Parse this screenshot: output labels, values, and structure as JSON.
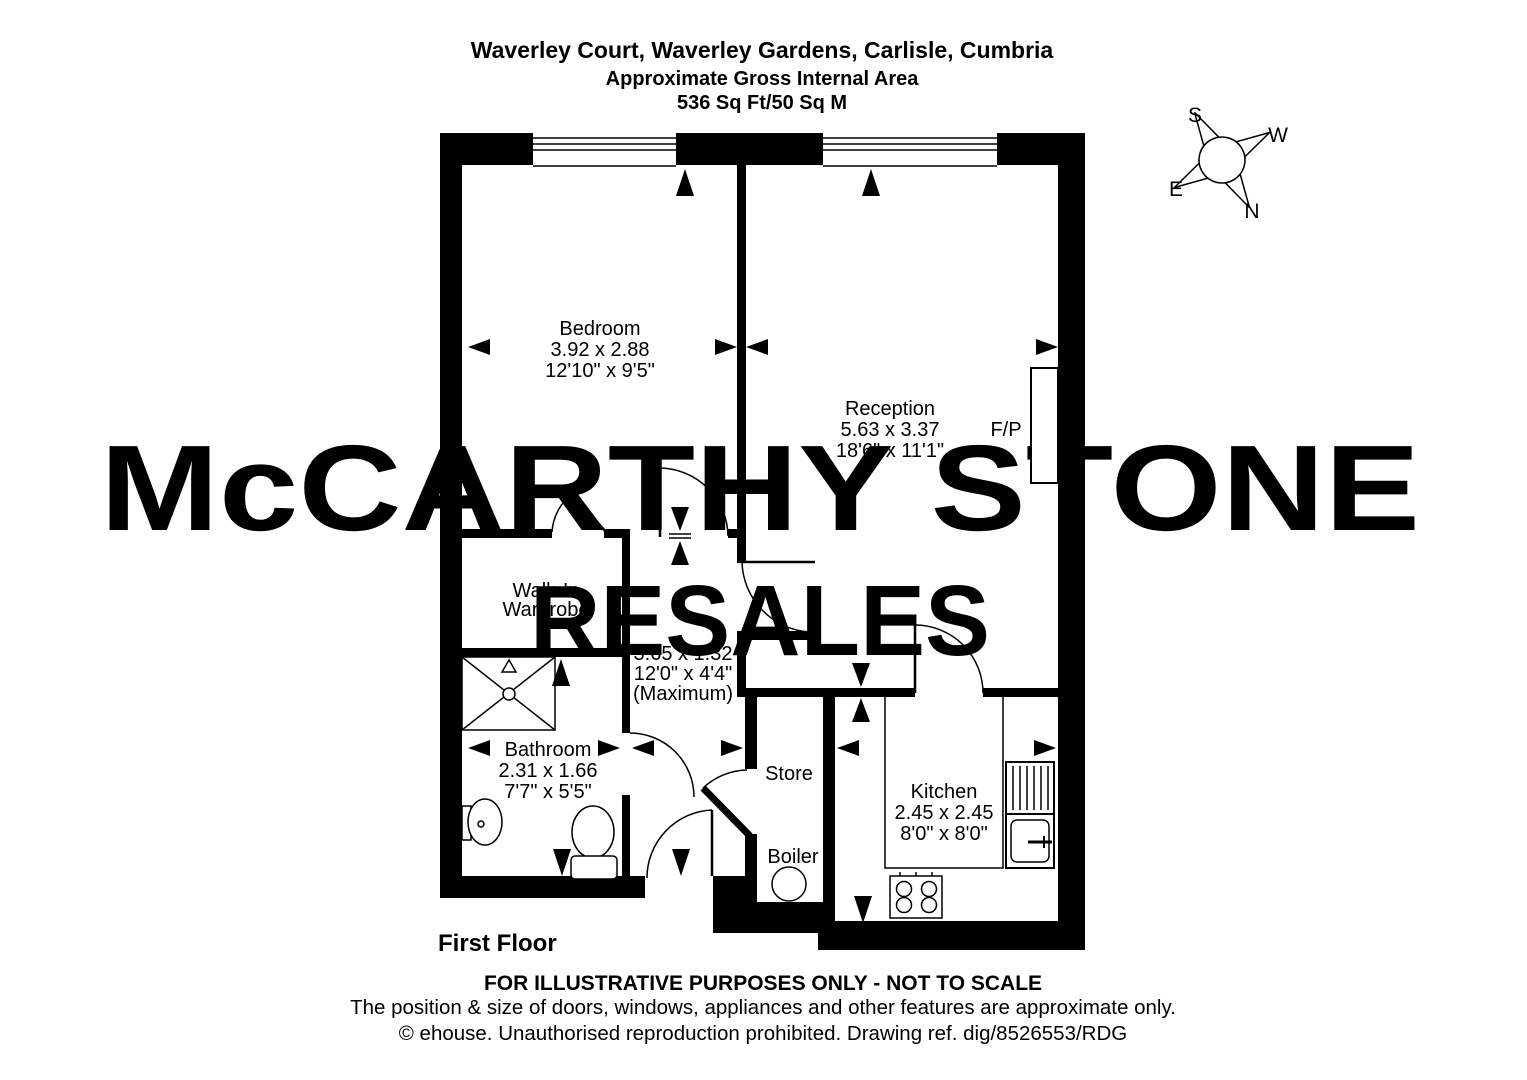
{
  "header": {
    "line1": "Waverley Court, Waverley Gardens, Carlisle, Cumbria",
    "line2": "Approximate Gross Internal Area",
    "line3": "536 Sq Ft/50 Sq M"
  },
  "watermark": {
    "primary": "McCARTHY STONE",
    "secondary": "RESALES"
  },
  "colors": {
    "watermark_gray": "#d6d6d6",
    "watermark_pink": "#f2c3d1",
    "wall_black": "#000000"
  },
  "compass": {
    "north": "N",
    "south": "S",
    "east": "E",
    "west": "W"
  },
  "rooms": {
    "bedroom": {
      "name": "Bedroom",
      "metric": "3.92 x 2.88",
      "imperial": "12'10\" x 9'5\""
    },
    "reception": {
      "name": "Reception",
      "metric": "5.63 x 3.37",
      "imperial": "18'6\" x 11'1\""
    },
    "fireplace": {
      "label": "F/P"
    },
    "wardrobe": {
      "line1": "Walk-In",
      "line2": "Wardrobe"
    },
    "hall": {
      "metric": "3.65 x 1.32",
      "imperial": "12'0\" x 4'4\"",
      "note": "(Maximum)"
    },
    "bathroom": {
      "name": "Bathroom",
      "metric": "2.31 x 1.66",
      "imperial": "7'7\" x 5'5\""
    },
    "store": {
      "name": "Store"
    },
    "boiler": {
      "name": "Boiler"
    },
    "kitchen": {
      "name": "Kitchen",
      "metric": "2.45 x 2.45",
      "imperial": "8'0\" x 8'0\""
    }
  },
  "floor_label": "First Floor",
  "footer": {
    "line1": "FOR ILLUSTRATIVE PURPOSES ONLY - NOT TO SCALE",
    "line2": "The position & size of doors, windows, appliances and other features are approximate only.",
    "line3": "© ehouse. Unauthorised reproduction prohibited. Drawing ref. dig/8526553/RDG"
  }
}
